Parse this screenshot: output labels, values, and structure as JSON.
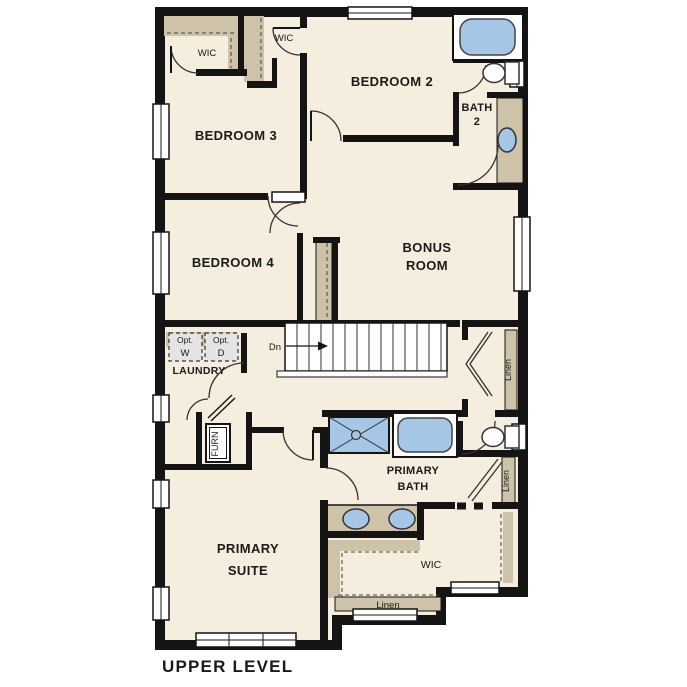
{
  "title": "UPPER LEVEL",
  "labels": {
    "bedroom2": "BEDROOM 2",
    "bedroom3": "BEDROOM 3",
    "bedroom4": "BEDROOM 4",
    "bonus_line1": "BONUS",
    "bonus_line2": "ROOM",
    "bath2_line1": "BATH",
    "bath2_line2": "2",
    "primary_bath_line1": "PRIMARY",
    "primary_bath_line2": "BATH",
    "primary_suite_line1": "PRIMARY",
    "primary_suite_line2": "SUITE",
    "laundry": "LAUNDRY",
    "wic_bedroom3": "WIC",
    "wic_bedroom2": "WIC",
    "wic_primary": "WIC",
    "linen_bonus": "Linen",
    "linen_hall": "Linen",
    "linen_strip": "Linen",
    "furnace": "FURN",
    "stairs_down": "Dn",
    "opt_washer_line1": "Opt.",
    "opt_washer_line2": "W",
    "opt_dryer_line1": "Opt.",
    "opt_dryer_line2": "D"
  },
  "colors": {
    "background": "#ffffff",
    "floor": "#f5eddd",
    "wall": "#141414",
    "shelf_tan": "#cec2a8",
    "fixture_blue": "#a5c6e5",
    "appliance_gray": "#e4e4e4"
  }
}
